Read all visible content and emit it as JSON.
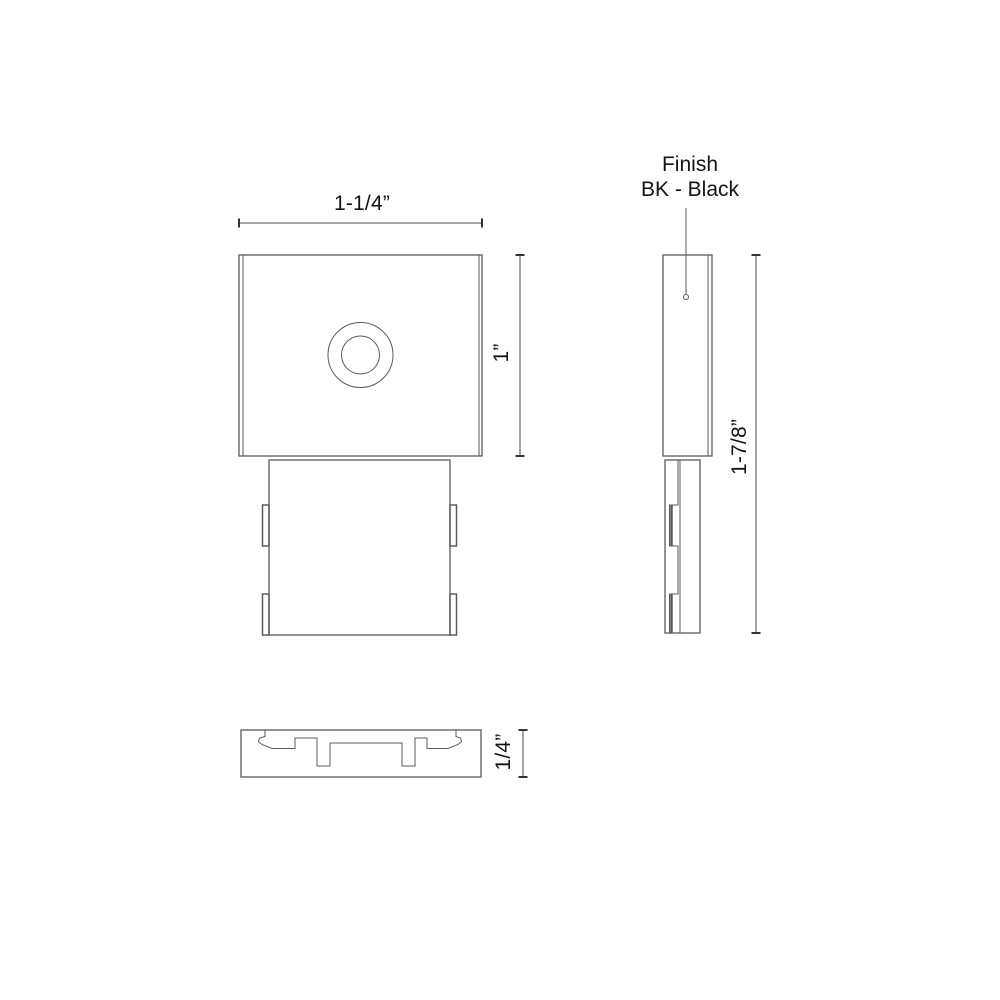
{
  "drawing": {
    "title": "mounting-clip-dimension-drawing",
    "colors": {
      "background": "#ffffff",
      "part_line": "#5b5b5b",
      "dimension_line": "#4d4d4d",
      "tick": "#333333",
      "text": "#141414"
    },
    "views": {
      "front": {
        "width_label": "1-1/4”",
        "height_label": "1”"
      },
      "side": {
        "height_label": "1-7/8”",
        "finish_line1": "Finish",
        "finish_line2": "BK - Black"
      },
      "bottom": {
        "thickness_label": "1/4”"
      }
    }
  }
}
